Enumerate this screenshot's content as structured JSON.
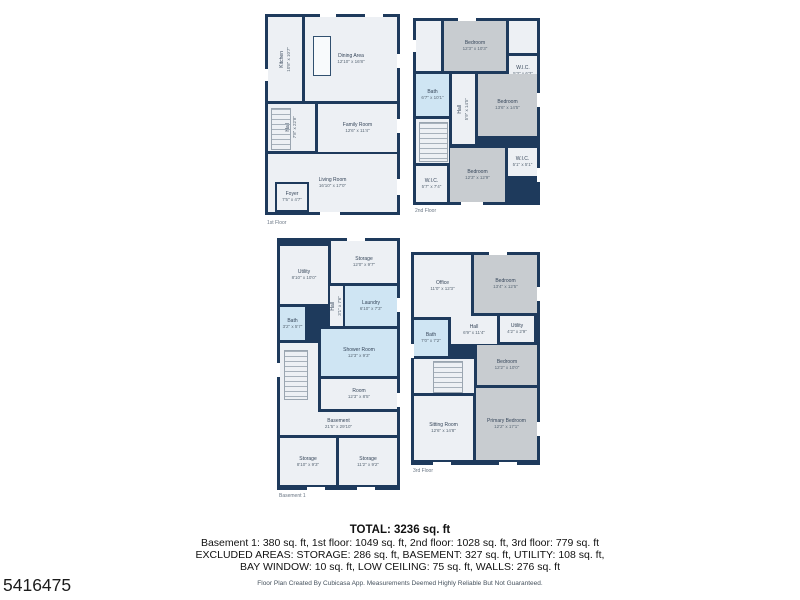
{
  "photo_id": "5416475",
  "colors": {
    "wall": "#1e3a5c",
    "floor": "#edf0f4",
    "bedroom_fill": "#c8ccd0",
    "wet_room_fill": "#cfe5f3",
    "page_background": "#ffffff"
  },
  "summary": {
    "total": "TOTAL: 3236 sq. ft",
    "breakdown": "Basement 1: 380 sq. ft, 1st floor: 1049 sq. ft, 2nd floor: 1028 sq. ft, 3rd floor: 779 sq. ft",
    "excluded1": "EXCLUDED AREAS: STORAGE: 286 sq. ft, BASEMENT: 327 sq. ft, UTILITY: 108 sq. ft,",
    "excluded2": "BAY WINDOW: 10 sq. ft, LOW CEILING: 75 sq. ft, WALLS: 276 sq. ft",
    "disclaimer": "Floor Plan Created By Cubicasa App. Measurements Deemed Highly Reliable But Not Guaranteed."
  },
  "floors": [
    {
      "label": "1st Floor",
      "rooms": [
        {
          "name": "Kitchen",
          "dims": "10'8\" x 10'7\""
        },
        {
          "name": "Dining Area",
          "dims": "12'10\" x 16'8\""
        },
        {
          "name": "Family Room",
          "dims": "12'6\" x 11'4\""
        },
        {
          "name": "Hall",
          "dims": "7'8\" x 22'8\""
        },
        {
          "name": "Living Room",
          "dims": "16'10\" x 17'0\""
        },
        {
          "name": "Foyer",
          "dims": "7'5\" x 4'7\""
        }
      ]
    },
    {
      "label": "2nd Floor",
      "rooms": [
        {
          "name": "Bedroom",
          "dims": "12'3\" x 10'3\""
        },
        {
          "name": "W.I.C.",
          "dims": "5'3\" x 6'3\""
        },
        {
          "name": "Bath",
          "dims": "6'7\" x 10'1\""
        },
        {
          "name": "Hall",
          "dims": "5'9\" x 14'5\""
        },
        {
          "name": "Bedroom",
          "dims": "13'6\" x 14'5\""
        },
        {
          "name": "W.I.C.",
          "dims": "5'7\" x 7'4\""
        },
        {
          "name": "Bedroom",
          "dims": "12'3\" x 12'9\""
        },
        {
          "name": "W.I.C.",
          "dims": "5'1\" x 5'1\""
        }
      ]
    },
    {
      "label": "Basement 1",
      "rooms": [
        {
          "name": "Utility",
          "dims": "8'10\" x 10'0\""
        },
        {
          "name": "Storage",
          "dims": "12'0\" x 9'7\""
        },
        {
          "name": "Hall",
          "dims": "3'1\" x 7'6\""
        },
        {
          "name": "Laundry",
          "dims": "6'10\" x 7'3\""
        },
        {
          "name": "Bath",
          "dims": "3'2\" x 5'7\""
        },
        {
          "name": "Shower Room",
          "dims": "12'3\" x 9'3\""
        },
        {
          "name": "Room",
          "dims": "12'3\" x 8'5\""
        },
        {
          "name": "Basement",
          "dims": "21'5\" x 29'10\""
        },
        {
          "name": "Storage",
          "dims": "8'10\" x 9'3\""
        },
        {
          "name": "Storage",
          "dims": "11'2\" x 9'2\""
        }
      ]
    },
    {
      "label": "3rd Floor",
      "rooms": [
        {
          "name": "Office",
          "dims": "11'0\" x 12'3\""
        },
        {
          "name": "Bedroom",
          "dims": "13'4\" x 12'5\""
        },
        {
          "name": "Bath",
          "dims": "7'0\" x 7'2\""
        },
        {
          "name": "Hall",
          "dims": "6'9\" x 11'4\""
        },
        {
          "name": "Utility",
          "dims": "4'2\" x 2'9\""
        },
        {
          "name": "Bedroom",
          "dims": "12'2\" x 10'0\""
        },
        {
          "name": "Sitting Room",
          "dims": "12'6\" x 14'8\""
        },
        {
          "name": "Primary Bedroom",
          "dims": "12'2\" x 17'1\""
        }
      ]
    }
  ]
}
